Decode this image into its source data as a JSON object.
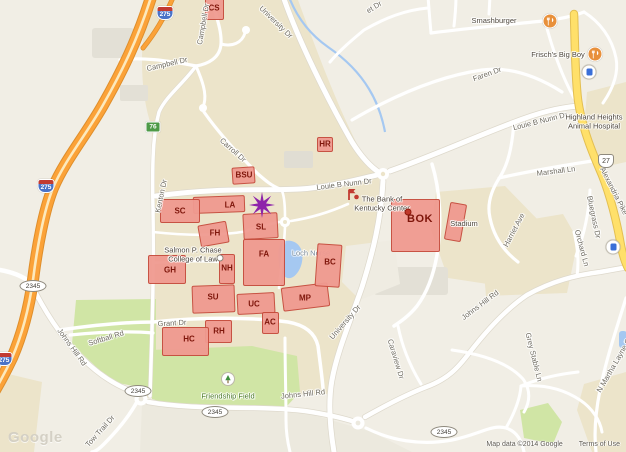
{
  "map": {
    "watermark": "Google",
    "attribution": "Map data ©2014 Google",
    "terms_link": "Terms of Use",
    "colors": {
      "highway_orange": "#FBA238",
      "major_road_yellow": "#FFE06A",
      "campus_tan": "#ECE4CA",
      "park_green": "#D0E5A5",
      "water_blue": "#A5C8F1",
      "building_red": "#F09A90",
      "building_border": "#C64B3C",
      "building_text": "#7E150A",
      "star_purple": "#8E24AA"
    },
    "buildings": [
      {
        "id": "cs",
        "label": "CS",
        "x": 205,
        "y": -8,
        "w": 19,
        "h": 28,
        "r": 0,
        "lx": 214,
        "ly": 8
      },
      {
        "id": "bsu",
        "label": "BSU",
        "x": 232,
        "y": 167,
        "w": 23,
        "h": 17,
        "r": -4,
        "lx": 244,
        "ly": 175
      },
      {
        "id": "hr",
        "label": "HR",
        "x": 317,
        "y": 137,
        "w": 16,
        "h": 15,
        "r": 0,
        "lx": 325,
        "ly": 144
      },
      {
        "id": "la",
        "label": "LA",
        "x": 193,
        "y": 196,
        "w": 52,
        "h": 17,
        "r": -2,
        "lx": 230,
        "ly": 205
      },
      {
        "id": "sc",
        "label": "SC",
        "x": 160,
        "y": 199,
        "w": 40,
        "h": 24,
        "r": 0,
        "lx": 180,
        "ly": 211
      },
      {
        "id": "fh",
        "label": "FH",
        "x": 199,
        "y": 223,
        "w": 29,
        "h": 22,
        "r": -10,
        "lx": 215,
        "ly": 233
      },
      {
        "id": "sl",
        "label": "SL",
        "x": 243,
        "y": 213,
        "w": 35,
        "h": 26,
        "r": -3,
        "lx": 261,
        "ly": 227
      },
      {
        "id": "fa",
        "label": "FA",
        "x": 243,
        "y": 239,
        "w": 42,
        "h": 47,
        "r": 0,
        "lx": 264,
        "ly": 254
      },
      {
        "id": "nh",
        "label": "NH",
        "x": 219,
        "y": 254,
        "w": 16,
        "h": 30,
        "r": 0,
        "lx": 227,
        "ly": 268
      },
      {
        "id": "gh",
        "label": "GH",
        "x": 148,
        "y": 255,
        "w": 38,
        "h": 29,
        "r": 0,
        "lx": 170,
        "ly": 270
      },
      {
        "id": "su",
        "label": "SU",
        "x": 192,
        "y": 285,
        "w": 43,
        "h": 28,
        "r": -2,
        "lx": 213,
        "ly": 297
      },
      {
        "id": "uc",
        "label": "UC",
        "x": 237,
        "y": 293,
        "w": 38,
        "h": 21,
        "r": -3,
        "lx": 254,
        "ly": 304
      },
      {
        "id": "mp",
        "label": "MP",
        "x": 282,
        "y": 285,
        "w": 47,
        "h": 24,
        "r": -7,
        "lx": 305,
        "ly": 298
      },
      {
        "id": "bc",
        "label": "BC",
        "x": 316,
        "y": 244,
        "w": 25,
        "h": 43,
        "r": 4,
        "lx": 330,
        "ly": 262
      },
      {
        "id": "ac",
        "label": "AC",
        "x": 262,
        "y": 312,
        "w": 17,
        "h": 22,
        "r": 0,
        "lx": 270,
        "ly": 322
      },
      {
        "id": "rh",
        "label": "RH",
        "x": 205,
        "y": 320,
        "w": 27,
        "h": 23,
        "r": 0,
        "lx": 219,
        "ly": 331
      },
      {
        "id": "hc",
        "label": "HC",
        "x": 162,
        "y": 327,
        "w": 47,
        "h": 29,
        "r": 0,
        "lx": 189,
        "ly": 339
      },
      {
        "id": "bok",
        "label": "BOK",
        "big": true,
        "x": 391,
        "y": 199,
        "w": 49,
        "h": 53,
        "r": 0,
        "lx": 420,
        "ly": 219
      },
      {
        "id": "stadium",
        "label": "",
        "x": 447,
        "y": 203,
        "w": 17,
        "h": 38,
        "r": 10,
        "lx": 0,
        "ly": 0
      }
    ],
    "labels": [
      {
        "k": "road",
        "t": "University Dr",
        "x": 276,
        "y": 22,
        "r": 44
      },
      {
        "k": "road",
        "t": "Campbell Dr",
        "x": 167,
        "y": 64,
        "r": -13
      },
      {
        "k": "road",
        "t": "Campbell Dr",
        "x": 203,
        "y": 24,
        "r": -80
      },
      {
        "k": "road",
        "t": "Carroll Dr",
        "x": 233,
        "y": 150,
        "r": 42
      },
      {
        "k": "road",
        "t": "Kenton Dr",
        "x": 161,
        "y": 196,
        "r": -78
      },
      {
        "k": "road",
        "t": "Louie B Nunn Dr",
        "x": 344,
        "y": 184,
        "r": -7
      },
      {
        "k": "road",
        "t": "Louie B Nunn Dr",
        "x": 540,
        "y": 121,
        "r": -14
      },
      {
        "k": "road",
        "t": "University Dr",
        "x": 345,
        "y": 322,
        "r": -49
      },
      {
        "k": "road",
        "t": "Grant Dr",
        "x": 172,
        "y": 323,
        "r": -3
      },
      {
        "k": "road",
        "t": "Johns Hill Rd",
        "x": 72,
        "y": 347,
        "r": 54
      },
      {
        "k": "road",
        "t": "Softball Rd",
        "x": 106,
        "y": 338,
        "r": -17
      },
      {
        "k": "road",
        "t": "Johns Hill Rd",
        "x": 303,
        "y": 394,
        "r": -6
      },
      {
        "k": "road",
        "t": "Johns Hill Rd",
        "x": 480,
        "y": 305,
        "r": -37
      },
      {
        "k": "road",
        "t": "Tow Trail Dr",
        "x": 100,
        "y": 431,
        "r": -48
      },
      {
        "k": "road",
        "t": "Faren Dr",
        "x": 487,
        "y": 74,
        "r": -20
      },
      {
        "k": "road",
        "t": "Marshall Ln",
        "x": 556,
        "y": 171,
        "r": -7
      },
      {
        "k": "road",
        "t": "Harriet Ave",
        "x": 514,
        "y": 230,
        "r": -62
      },
      {
        "k": "road",
        "t": "Bluegrass Dr",
        "x": 594,
        "y": 217,
        "r": 78
      },
      {
        "k": "road",
        "t": "Orchard Ln",
        "x": 582,
        "y": 248,
        "r": 75
      },
      {
        "k": "road",
        "t": "Grey Stable Ln",
        "x": 534,
        "y": 357,
        "r": 76
      },
      {
        "k": "road",
        "t": "Caraview Dr",
        "x": 396,
        "y": 359,
        "r": 73
      },
      {
        "k": "road",
        "t": "N Martha Layne Collins",
        "x": 618,
        "y": 358,
        "r": -60
      },
      {
        "k": "road",
        "t": "Alexandria Pike",
        "x": 614,
        "y": 191,
        "r": 63
      },
      {
        "k": "road",
        "t": "et Dr",
        "x": 374,
        "y": 7,
        "r": -32
      },
      {
        "k": "water",
        "t": "Loch Norse",
        "x": 311,
        "y": 253,
        "r": 0,
        "under": true
      },
      {
        "k": "poi",
        "t": "Smashburger",
        "x": 494,
        "y": 21,
        "i": true
      },
      {
        "k": "poi",
        "t": "Frisch's Big Boy",
        "x": 558,
        "y": 55,
        "i": true
      },
      {
        "k": "poi",
        "lines": [
          "Highland Heights",
          "Animal Hospital"
        ],
        "x": 594,
        "y": 122,
        "i": true
      },
      {
        "k": "poi",
        "lines": [
          "The Bank of",
          "Kentucky Center"
        ],
        "x": 382,
        "y": 204,
        "i": true
      },
      {
        "k": "poi",
        "lines": [
          "Salmon P. Chase",
          "College of Law"
        ],
        "x": 193,
        "y": 255,
        "i": true
      },
      {
        "k": "poi",
        "t": "Stadium",
        "x": 464,
        "y": 224,
        "i": true
      },
      {
        "k": "park",
        "t": "Friendship Field",
        "x": 228,
        "y": 396,
        "i": true
      }
    ],
    "shields": [
      {
        "type": "interstate",
        "t": "275",
        "x": 165,
        "y": 13
      },
      {
        "type": "interstate",
        "t": "275",
        "x": 46,
        "y": 186
      },
      {
        "type": "interstate",
        "t": "275",
        "x": 4,
        "y": 359
      },
      {
        "type": "exit",
        "t": "76",
        "x": 153,
        "y": 127
      },
      {
        "type": "oval",
        "t": "2345",
        "x": 33,
        "y": 286
      },
      {
        "type": "oval",
        "t": "2345",
        "x": 138,
        "y": 391
      },
      {
        "type": "oval",
        "t": "2345",
        "x": 215,
        "y": 412
      },
      {
        "type": "oval",
        "t": "2345",
        "x": 444,
        "y": 432
      },
      {
        "type": "us",
        "t": "27",
        "x": 606,
        "y": 161
      }
    ],
    "icons": [
      {
        "type": "restaurant",
        "x": 550,
        "y": 21
      },
      {
        "type": "restaurant",
        "x": 595,
        "y": 54
      },
      {
        "type": "shop",
        "x": 589,
        "y": 72
      },
      {
        "type": "shop",
        "x": 613,
        "y": 247
      },
      {
        "type": "tree",
        "x": 228,
        "y": 379
      },
      {
        "type": "red-marker",
        "x": 353,
        "y": 194
      },
      {
        "type": "dot",
        "x": 408,
        "y": 212
      },
      {
        "type": "small-dot",
        "x": 220,
        "y": 258
      },
      {
        "type": "star",
        "x": 262,
        "y": 205
      }
    ]
  }
}
